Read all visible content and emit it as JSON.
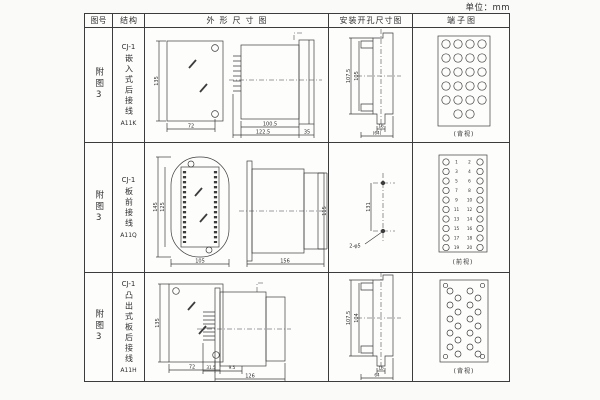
{
  "unit_label": "单位：mm",
  "header": {
    "fig_no": "图号",
    "structure": "结构",
    "outline": "外形尺寸图",
    "install": "安装开孔尺寸图",
    "terminal": "端子图"
  },
  "rows": [
    {
      "fig_no": "附图3",
      "model": "CJ-1",
      "structure": "嵌入式后接线",
      "code": "A11K",
      "outline": {
        "front_h": "135",
        "front_w": "72",
        "d1": "100.5",
        "d2": "122.5",
        "d3": "35"
      },
      "install": {
        "outer": "107.5",
        "inner": "105",
        "slot": "16",
        "width": "(64)"
      },
      "terminal": {
        "caption": "(背视)"
      }
    },
    {
      "fig_no": "附图3",
      "model": "CJ-1",
      "structure": "板前接线",
      "code": "A11Q",
      "outline": {
        "front_h": "145",
        "inner_h": "125",
        "front_w": "105",
        "d1": "156",
        "d2": "115"
      },
      "install": {
        "span": "131",
        "holes": "2-φ5"
      },
      "terminal": {
        "caption": "(前视)",
        "left": [
          "1",
          "3",
          "5",
          "7",
          "9",
          "11",
          "13",
          "15",
          "17",
          "19"
        ],
        "right": [
          "2",
          "4",
          "6",
          "8",
          "10",
          "12",
          "14",
          "16",
          "18",
          "20"
        ]
      }
    },
    {
      "fig_no": "附图3",
      "model": "CJ-1",
      "structure": "凸出式板后接线",
      "code": "A11H",
      "outline": {
        "front_h": "135",
        "front_w": "72",
        "d1": "31.5",
        "d2": "9.5",
        "d3": "126"
      },
      "install": {
        "outer": "107.5",
        "inner": "104",
        "slot": "16",
        "width": "64"
      },
      "terminal": {
        "caption": "(背视)"
      }
    }
  ]
}
